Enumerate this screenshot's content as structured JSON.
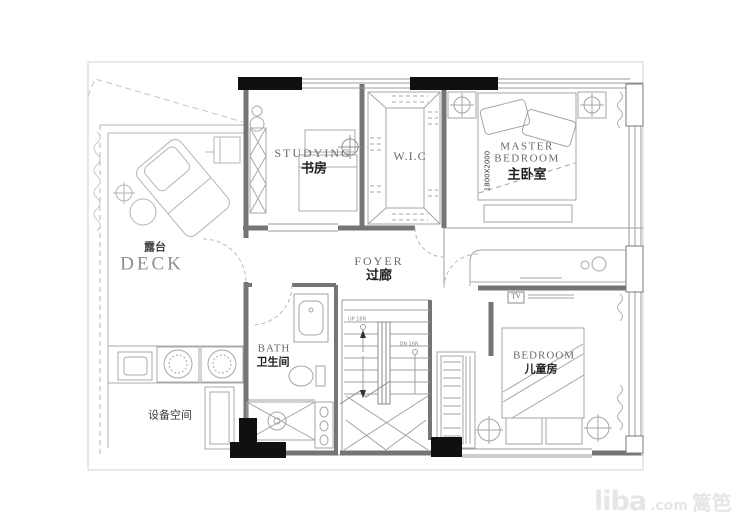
{
  "rooms": {
    "studying": {
      "en": "STUDYING",
      "zh": "书房"
    },
    "wic": {
      "en": "W.I.C"
    },
    "master": {
      "en_line1": "MASTER",
      "en_line2": "BEDROOM",
      "zh": "主卧室",
      "bed_dim": "1800X2000"
    },
    "deck": {
      "zh": "露台",
      "en": "DECK"
    },
    "foyer": {
      "en": "FOYER",
      "zh": "过廊"
    },
    "bath": {
      "en": "BATH",
      "zh": "卫生间"
    },
    "kids_bedroom": {
      "en": "BEDROOM",
      "zh": "儿童房"
    },
    "equipment": {
      "zh": "设备空间"
    }
  },
  "stairs": {
    "up_label": "UP 16R",
    "down_label": "DN 16R"
  },
  "annotations": {
    "tv": "TV"
  },
  "watermark": {
    "brand": "liba",
    "suffix": ".com",
    "site_name": "篱笆网"
  },
  "colors": {
    "walls": "#757575",
    "furniture_lines": "#a5a5a5",
    "structural_columns": "#101010",
    "label_en": "#6a6a6a",
    "label_zh": "#1f1f1f",
    "watermark": "#e6e6e6"
  }
}
